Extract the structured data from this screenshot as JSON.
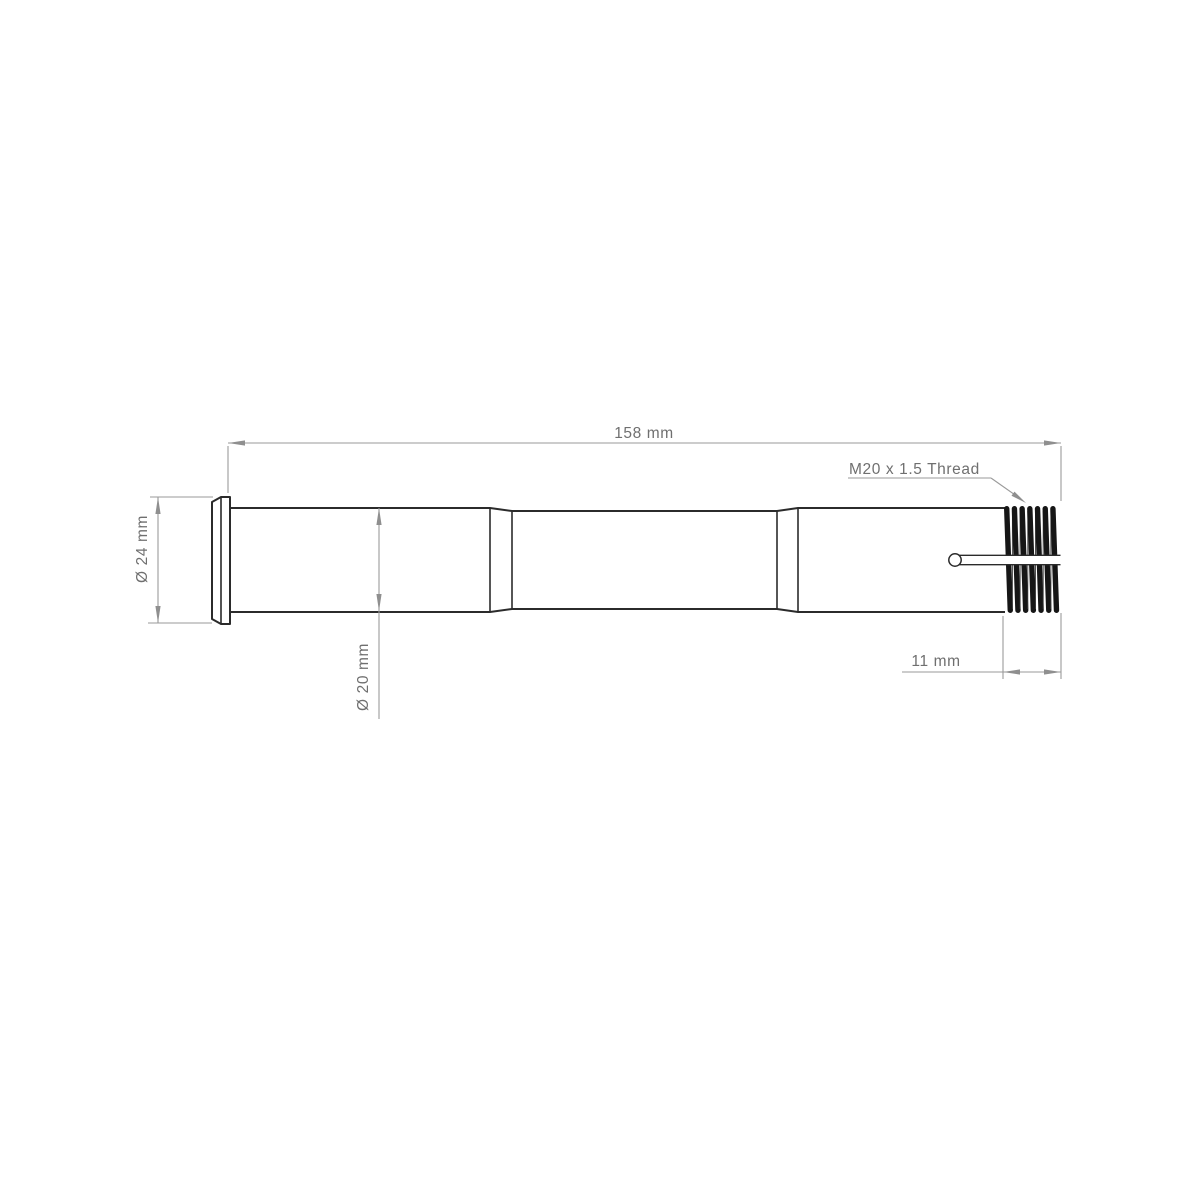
{
  "drawing": {
    "type": "technical-drawing",
    "subject": "thru-axle side view",
    "dimensions": {
      "overall_length_label": "158 mm",
      "thread_label": "M20 x 1.5 Thread",
      "head_diameter_label": "Ø 24 mm",
      "shaft_diameter_label": "Ø 20 mm",
      "thread_length_label": "11 mm"
    },
    "colors": {
      "background": "#ffffff",
      "part_outline": "#2b2b2b",
      "thread_fill": "#161616",
      "dimension_lines": "#9a9a9a",
      "dimension_text": "#6f6f6f"
    }
  }
}
